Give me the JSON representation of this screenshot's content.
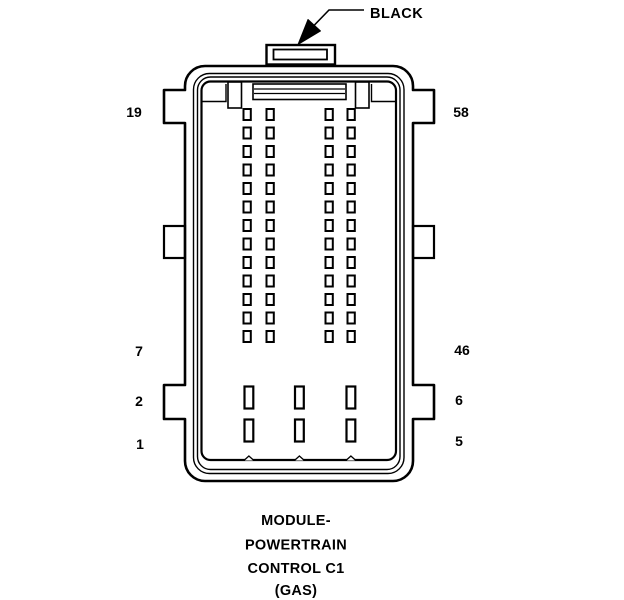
{
  "figure": {
    "callout": {
      "label": "BLACK"
    },
    "pin_labels": {
      "top_left": "19",
      "top_right": "58",
      "middle_left": "7",
      "middle_right": "46",
      "lower_left": "2",
      "lower_right": "6",
      "bottom_left": "1",
      "bottom_right": "5"
    },
    "caption": {
      "lines": [
        "MODULE-",
        "POWERTRAIN",
        "CONTROL C1",
        "(GAS)"
      ]
    },
    "pin_grid": {
      "small_pins": {
        "rows": 13,
        "cols": 4,
        "total": 52
      },
      "large_pins": {
        "rows": 2,
        "cols": 3,
        "total": 6
      },
      "total_cavities": 58
    },
    "colors": {
      "ink": "#000000",
      "paper": "#ffffff"
    }
  }
}
